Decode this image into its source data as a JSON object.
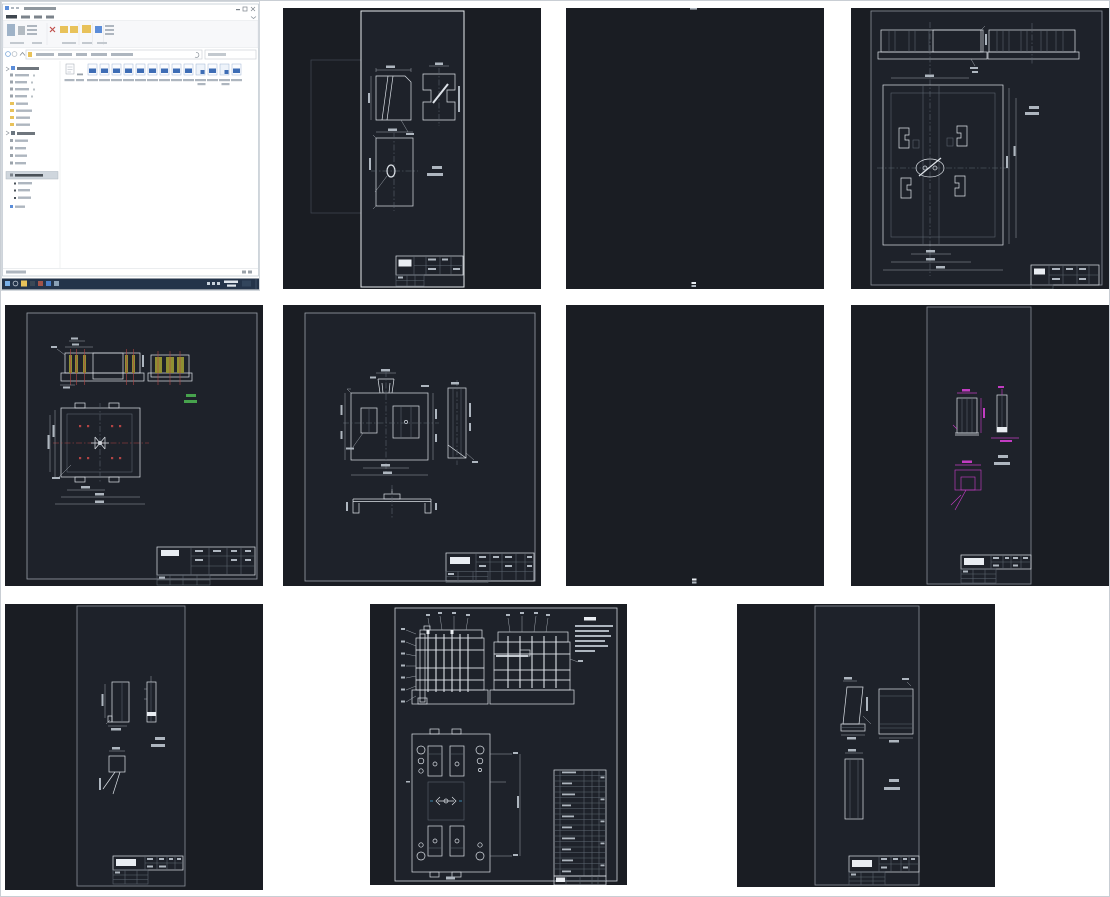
{
  "page": {
    "background": "#ffffff",
    "border": "#c9ced4",
    "description": "Gallery grid of one Windows File Explorer desktop screenshot and ten dark-background AutoCAD drawing thumbnails (Chinese mold/die design drawing set); all embedded text is below legibility at this resolution"
  },
  "palette": {
    "page_bg": "#ffffff",
    "page_border": "#c9ced4",
    "cad_bg": "#1a1d23",
    "cad_sheet": "#1e222a",
    "line_bright": "#dde2e8",
    "line_dim": "#aab1b9",
    "line_gray": "#5f6872",
    "line_faint": "#424a54",
    "smudge": "#aeb6bf",
    "smudge_bright": "#e9edf2",
    "green": "#47a34d",
    "magenta": "#c23cc2",
    "olive": "#8f8f33",
    "red": "#b24444",
    "cyan": "#45a8d8",
    "taskbar": "#24344a",
    "folder_yellow": "#e8c25a",
    "icon_blue": "#3e6db5",
    "accent_blue": "#5b8dd9",
    "win_bg": "#ffffff",
    "ribbon_bg": "#f7f8fa",
    "win_border": "#b9c3cc"
  },
  "explorer": {
    "kind": "windows-10-file-explorer-desktop-screenshot",
    "ribbon_tab_count": 4,
    "tree_item_count": 19,
    "selected_tree_item_index": 14,
    "visible_file_icon_count": 15,
    "file_icon_type": "dwg-drawing-files",
    "taskbar_icon_count": 7
  },
  "thumbnails": [
    {
      "id": "t1",
      "name": "explorer-desktop",
      "kind": "screenshot",
      "description": "File Explorer window over desktop with taskbar"
    },
    {
      "id": "t2",
      "name": "punch-part-drawing",
      "kind": "cad-drawing",
      "description": "Portrait sheet: hatched section, I-profile view, rectangular plan with ellipse, title block"
    },
    {
      "id": "t3",
      "name": "blank-sheet-1",
      "kind": "cad-drawing",
      "description": "Nearly empty dark sheet, tiny marks top and bottom center"
    },
    {
      "id": "t4",
      "name": "die-plate-drawing",
      "kind": "cad-drawing",
      "description": "Hatched section strip above large nested-rectangle plan view with four cutouts, title block"
    },
    {
      "id": "t5",
      "name": "fixed-plate-drawing",
      "kind": "cad-drawing",
      "description": "Section with olive pin bars and red centerlines, plan view, green note, title block"
    },
    {
      "id": "t6",
      "name": "stripper-plate-drawing",
      "kind": "cad-drawing",
      "description": "Plan, side view and channel section of a plate, title block"
    },
    {
      "id": "t7",
      "name": "blank-sheet-2",
      "kind": "cad-drawing",
      "description": "Nearly empty dark sheet, tiny mark bottom center"
    },
    {
      "id": "t8",
      "name": "insert-part-magenta",
      "kind": "cad-drawing",
      "description": "Portrait sheet, two small part views and U-profile dimensioned in magenta, title block"
    },
    {
      "id": "t9",
      "name": "insert-part-white",
      "kind": "cad-drawing",
      "description": "Portrait sheet, two tall part views and small square part with leaders, title block"
    },
    {
      "id": "t10",
      "name": "mold-assembly-drawing",
      "kind": "cad-drawing",
      "description": "Assembly: two green-hatched sectional views with balloon leaders, notes, plan view, parts list table"
    },
    {
      "id": "t11",
      "name": "wedge-part-drawing",
      "kind": "cad-drawing",
      "description": "Portrait sheet, hatched wedge section, block view, tall rectangle view, title block"
    }
  ]
}
